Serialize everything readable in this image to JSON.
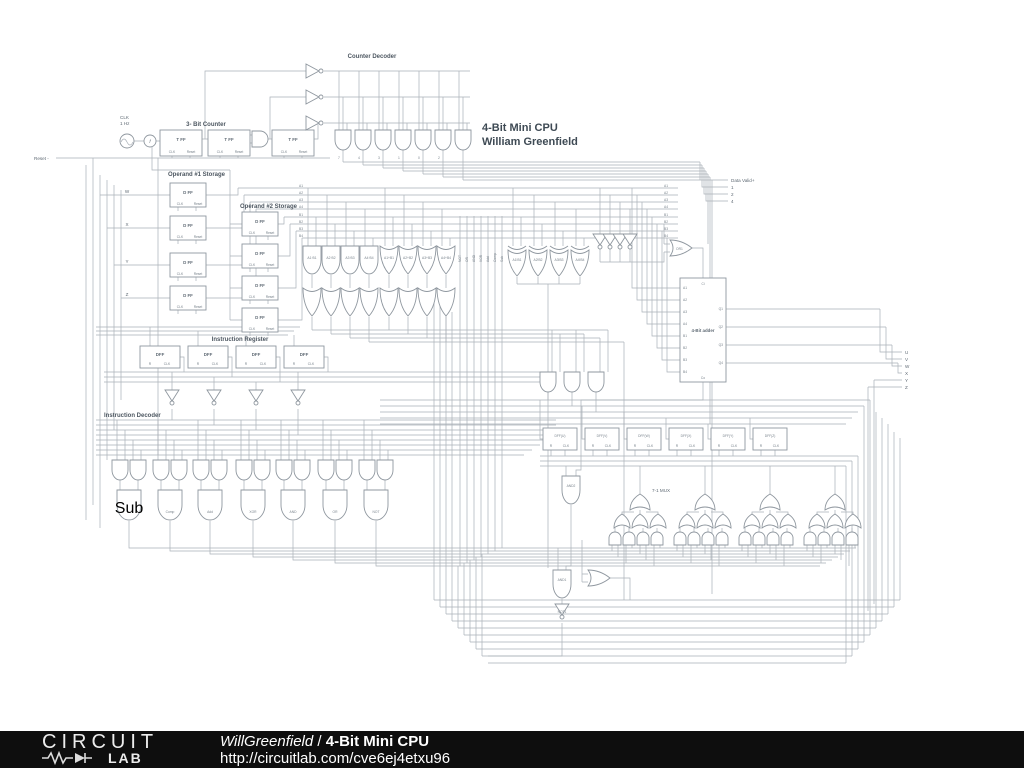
{
  "sch": {
    "title1": "4-Bit Mini CPU",
    "title2": "William Greenfield",
    "clk": {
      "l1": "CLK",
      "l2": "1 Hz",
      "f": "f"
    },
    "counter": {
      "label": "3- Bit Counter",
      "ff": "T FF"
    },
    "pin": {
      "clk": "CLK",
      "reset": "Reset",
      "r": "R"
    },
    "decoder": {
      "label": "Counter Decoder",
      "nums": [
        "7",
        "4",
        "3",
        "1",
        "0",
        "2"
      ]
    },
    "reset": "Reset -",
    "inputs": [
      "W",
      "X",
      "Y",
      "Z"
    ],
    "op1": {
      "label": "Operand #1 Storage",
      "ff": "D FF"
    },
    "op2": {
      "label": "Operand #2 Storage"
    },
    "abus": [
      "A1",
      "A2",
      "A3",
      "A4"
    ],
    "bbus": [
      "B1",
      "B2",
      "B3",
      "B4"
    ],
    "andg": [
      "A1·B1",
      "A2·B2",
      "A3·B3",
      "A4·B4"
    ],
    "org": [
      "A1+B1",
      "A2+B2",
      "A3+B3",
      "A4+B4"
    ],
    "xorg": [
      "A1!B1",
      "A2!B2",
      "A3!B3",
      "A4!B4"
    ],
    "ops": [
      "NOT",
      "OR",
      "AND",
      "XOR",
      "Add",
      "Comp",
      "Sub"
    ],
    "or1": "OR1",
    "adder": {
      "label": "4-Bit adder",
      "a": [
        "A1",
        "A2",
        "A3",
        "A4"
      ],
      "b": [
        "B1",
        "B2",
        "B3",
        "B4"
      ],
      "q": [
        "Q1",
        "Q2",
        "Q3",
        "Q4"
      ],
      "ci": "Ci",
      "co": "Co"
    },
    "dv": {
      "label": "Data Valid+",
      "bits": [
        "1",
        "2",
        "4"
      ]
    },
    "ir": {
      "label": "Instruction Register",
      "ff": "DFF"
    },
    "id": {
      "label": "Instruction Decoder",
      "ops": [
        "Sub",
        "Comp",
        "Add",
        "XOR",
        "AND",
        "OR",
        "NOT"
      ]
    },
    "rdff": [
      "DFF(U)",
      "DFF(V)",
      "DFF(W)",
      "DFF(X)",
      "DFF(Y)",
      "DFF(Z)"
    ],
    "mux": {
      "label": "7-1 MUX",
      "and2": "AND2"
    },
    "g": {
      "and1": "AND1",
      "not1": "NOT1"
    },
    "outs": [
      "U",
      "V",
      "W",
      "X",
      "Y",
      "Z"
    ]
  },
  "footer": {
    "brand_top": "CIRCUIT",
    "brand_bottom": "LAB",
    "author": "WillGreenfield",
    "separator": "/",
    "title": "4-Bit Mini CPU",
    "url": "http://circuitlab.com/cve6ej4etxu96"
  }
}
